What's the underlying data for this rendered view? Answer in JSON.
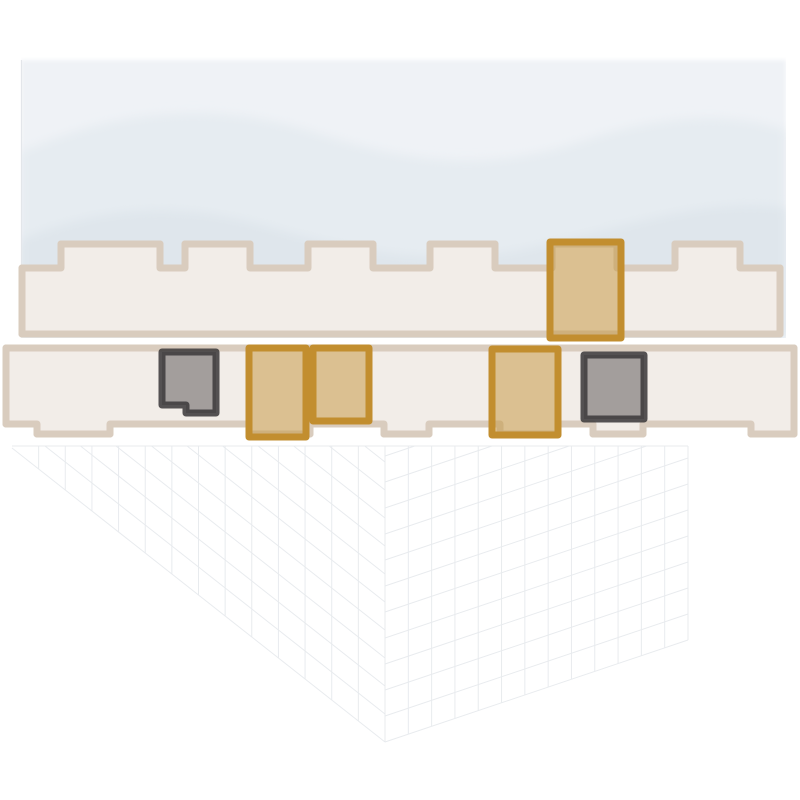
{
  "canvas": {
    "width": 800,
    "height": 800,
    "background": "#ffffff"
  },
  "palette": {
    "wave_base": "#eff2f6",
    "wave_mid": "#e6ecf1",
    "wave_deep": "#dfe6ec",
    "band_edge": "#e3e6ea",
    "strip_outline": "#d9ccbe",
    "strip_fill": "#f2ede8",
    "plan_line": "#b3aaa2",
    "plan_line_dark": "#9a928b",
    "gold_stroke": "#c28e2f",
    "gold_fill": "rgba(196,148,58,0.5)",
    "dark_stroke": "rgba(62,59,60,0.88)",
    "dark_fill": "rgba(84,80,80,0.5)",
    "wireframe_line": "#dde1e6"
  },
  "scene": {
    "upper_floor_units_highlighted": 1,
    "lower_floor_units_highlighted": 5,
    "gold_unit_count": 4,
    "dark_unit_count": 2
  },
  "units": [
    {
      "id": "unit-upper-gold-1",
      "floor": "upper",
      "highlight": "gold",
      "path": "M550 242 H621 V338 H550 Z"
    },
    {
      "id": "unit-lower-dark-1",
      "floor": "lower",
      "highlight": "dark",
      "path": "M162 352 H216 V413 H186 V405 H162 Z"
    },
    {
      "id": "unit-lower-gold-1",
      "floor": "lower",
      "highlight": "gold",
      "path": "M249 348 H306 V437 H249 Z"
    },
    {
      "id": "unit-lower-gold-2",
      "floor": "lower",
      "highlight": "gold",
      "path": "M313 348 H369 V421 H313 Z"
    },
    {
      "id": "unit-lower-gold-3",
      "floor": "lower",
      "highlight": "gold",
      "path": "M492 349 H558 V435 H492 Z"
    },
    {
      "id": "unit-lower-dark-2",
      "floor": "lower",
      "highlight": "dark",
      "path": "M584 355 H644 V419 H584 Z"
    }
  ]
}
